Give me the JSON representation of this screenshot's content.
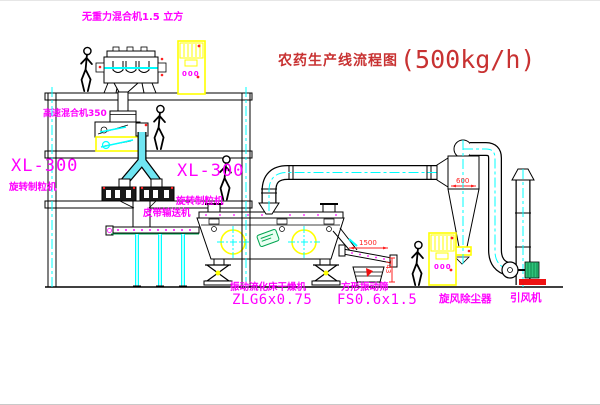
{
  "title": {
    "name": "农药生产线流程图",
    "capacity": "(500kg/h)"
  },
  "labels": {
    "gravity_mixer": "无重力混合机1.5 立方",
    "high_speed_mixer": "高速混合机350",
    "granulator_left_model": "XL-300",
    "granulator_left_name": "旋转制粒机",
    "granulator_right_model": "XL-300",
    "granulator_right_name": "旋转制粒机",
    "belt_conveyor": "皮带输送机",
    "dryer_name": "振动流化床干燥机",
    "dryer_model": "ZLG6x0.75",
    "screen_name": "方形振动筛",
    "screen_model": "FS0.6x1.5",
    "cyclone": "旋风除尘器",
    "fan": "引风机"
  },
  "dimensions": {
    "cyclone_width": "600",
    "screen_length": "1500",
    "screen_height": "743"
  },
  "cabinets": {
    "left_display": "000",
    "right_display": "000"
  },
  "colors": {
    "label_magenta": "#ff00ff",
    "title_red": "#c83232",
    "dimension_red": "#ff2020",
    "centerline_cyan": "#00ffff",
    "highlight_yellow": "#ffff00",
    "pipe_cyan_fill": "#6fe5f2",
    "motor_green": "#2ec47b",
    "base_red": "#ee1111"
  }
}
